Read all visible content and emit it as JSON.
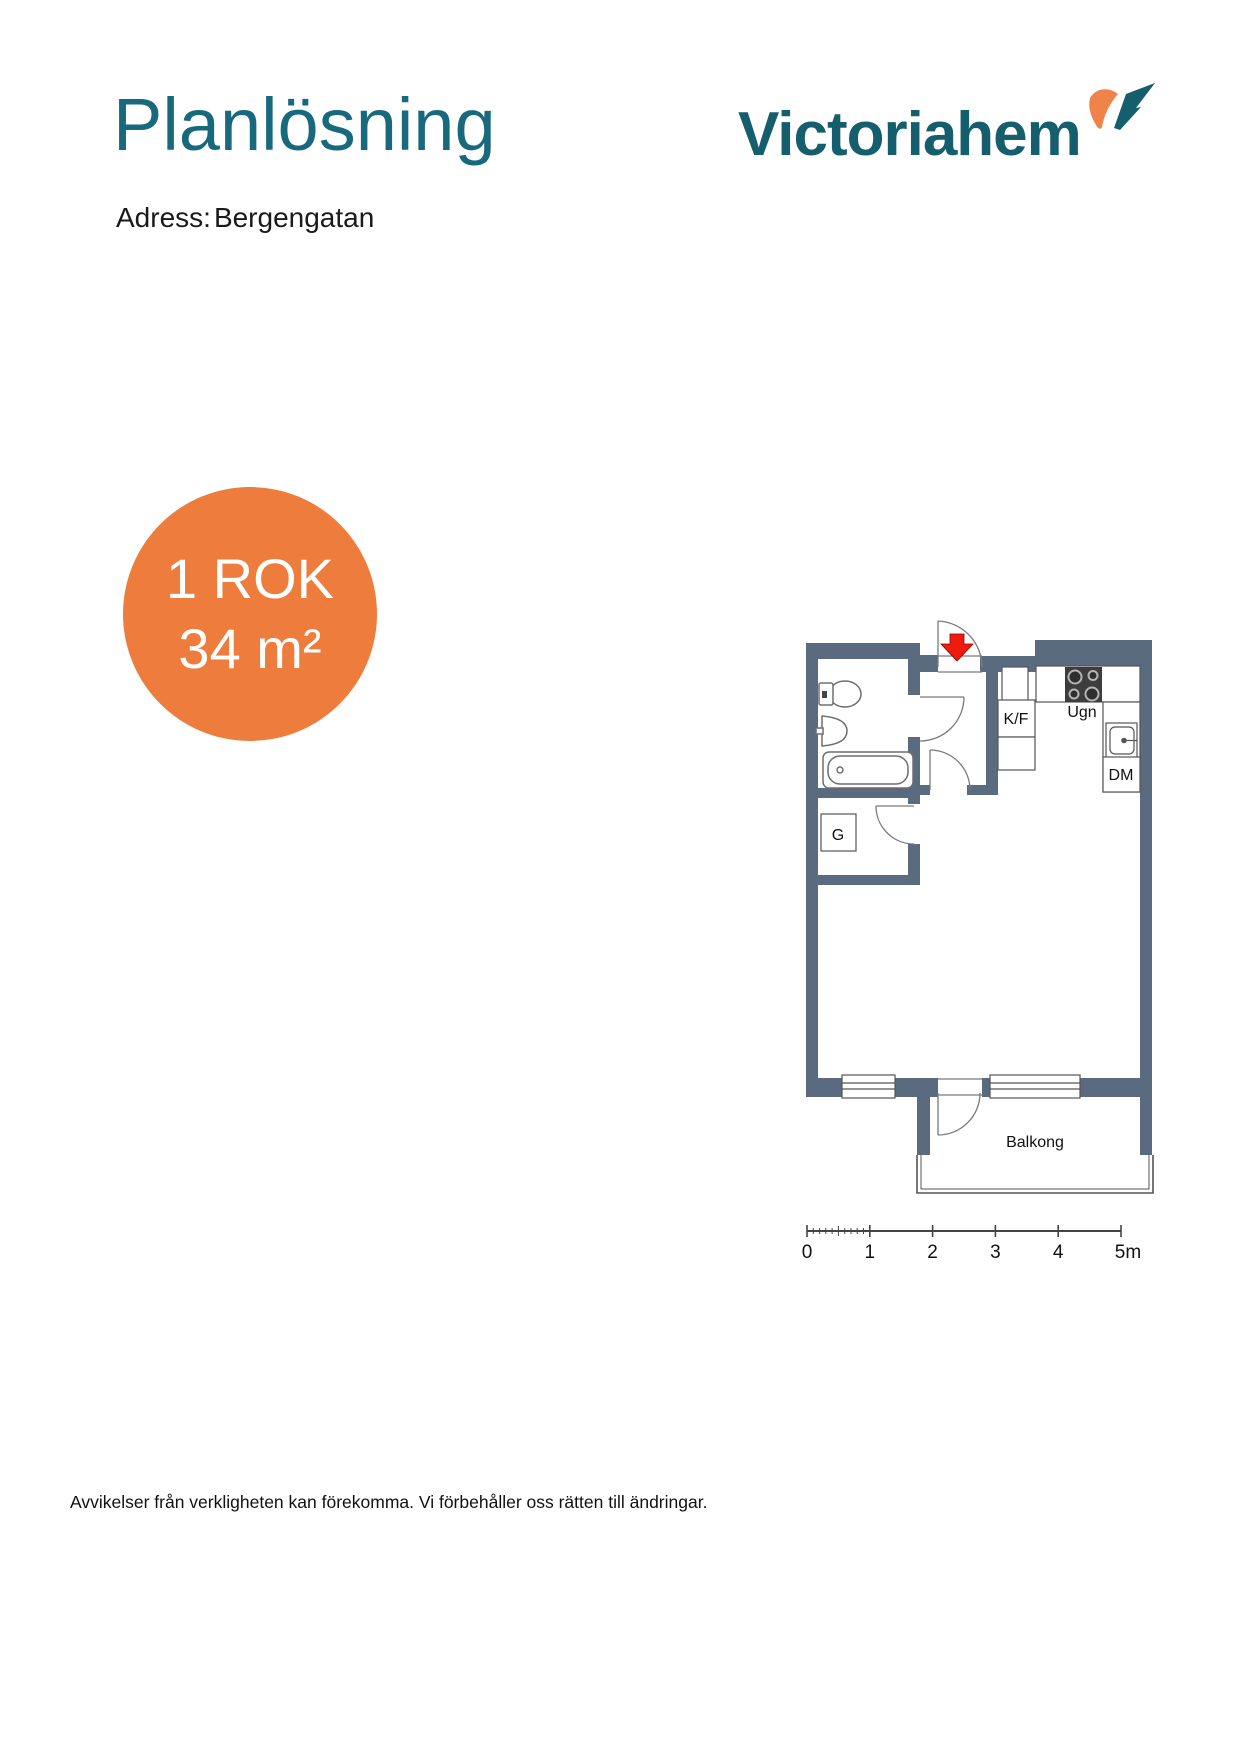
{
  "header": {
    "title": "Planlösning",
    "address_label": "Adress:",
    "address_value": "Bergengatan"
  },
  "logo": {
    "text": "Victoriahem"
  },
  "badge": {
    "line1": "1 ROK",
    "line2": "34 m²"
  },
  "floorplan": {
    "labels": {
      "fridge_freezer": "K/F",
      "oven": "Ugn",
      "dishwasher": "DM",
      "wardrobe": "G",
      "balcony": "Balkong"
    },
    "scale_bar": {
      "tick_labels": [
        "0",
        "1",
        "2",
        "3",
        "4",
        "5m"
      ]
    }
  },
  "footer": {
    "disclaimer": "Avvikelser från verkligheten kan förekomma. Vi förbehåller oss rätten till ändringar."
  },
  "colors": {
    "heading_teal": "#19697e",
    "logo_teal": "#155e6d",
    "accent_orange": "#ee7c3c",
    "wall_slate": "#5b6b7f",
    "entrance_red": "#ed1c0f"
  }
}
